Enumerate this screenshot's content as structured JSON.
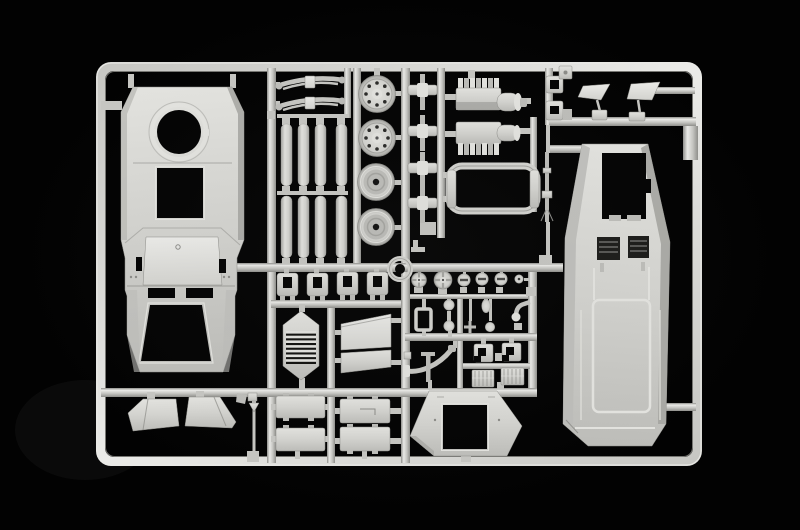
{
  "image": {
    "width": 800,
    "height": 530,
    "description": "Photograph of an injection-moulded model kit sprue of light grey styrene parts on a black background",
    "subject": "plastic model kit parts frame (sprue)"
  },
  "palette": {
    "background": "#020202",
    "runner": "#c6c6c2",
    "runner_highlight": "#ebebe8",
    "runner_shadow": "#8f8f8b",
    "plastic": "#d3d3cf",
    "plastic_light": "#e3e3df",
    "plastic_mid": "#bdbdb9",
    "plastic_dark": "#a5a5a1",
    "plastic_deep": "#8b8b87",
    "opening": "#030303",
    "recess": "#1c1c1a"
  },
  "sprue": {
    "material": "light grey polystyrene",
    "frame": {
      "x": 96,
      "y": 62,
      "width": 606,
      "height": 404,
      "corner_radius": 15
    },
    "parts": [
      {
        "id": "hull-superstructure-panel",
        "label": "superstructure top panel with turret ring, square hatch and windshield frame"
      },
      {
        "id": "leaf-springs",
        "label": "two leaf spring suspension parts"
      },
      {
        "id": "stowage-cylinders",
        "label": "eight cylindrical tank parts in two rows"
      },
      {
        "id": "bolted-wheels",
        "label": "two bolted-rim wheels"
      },
      {
        "id": "hub-wheels",
        "label": "two smooth hub wheels"
      },
      {
        "id": "axle-shafts",
        "label": "four axle shaft assemblies"
      },
      {
        "id": "engine-blocks",
        "label": "two engine block halves with air cleaner drums"
      },
      {
        "id": "chassis-frame-ring",
        "label": "oval chassis frame ring"
      },
      {
        "id": "machine-gun",
        "label": "thin machine gun part"
      },
      {
        "id": "clamp-brackets",
        "label": "small clamp brackets"
      },
      {
        "id": "rear-view-mirrors",
        "label": "two rear-view mirrors on stalks"
      },
      {
        "id": "cab-front-panel",
        "label": "large cab front hull panel with windshield opening and radiator recesses"
      },
      {
        "id": "towing-ring",
        "label": "round towing ring"
      },
      {
        "id": "hinge-hasps",
        "label": "four hinge hasp brackets"
      },
      {
        "id": "louvered-grille",
        "label": "hexagonal louvered grille"
      },
      {
        "id": "glacis-wedge-panels",
        "label": "two wedge glacis panels"
      },
      {
        "id": "access-doors",
        "label": "four rectangular access door panels"
      },
      {
        "id": "control-wheels-and-knobs",
        "label": "row of hand wheels and slotted knobs"
      },
      {
        "id": "ball-and-bulb-fittings",
        "label": "small ball, bulb and elbow fittings"
      },
      {
        "id": "window-frame-loop",
        "label": "small rectangular frame loop"
      },
      {
        "id": "exhaust-pipe",
        "label": "curved exhaust pipe with flange"
      },
      {
        "id": "towing-shackles",
        "label": "two square towing shackle hooks"
      },
      {
        "id": "tread-plates",
        "label": "two textured tread plates"
      },
      {
        "id": "roof-hatch-frame",
        "label": "hexagonal roof plate with square hatch opening"
      },
      {
        "id": "mud-flaps",
        "label": "two angled mud flaps"
      },
      {
        "id": "antenna-rod",
        "label": "thin antenna rod"
      }
    ]
  }
}
